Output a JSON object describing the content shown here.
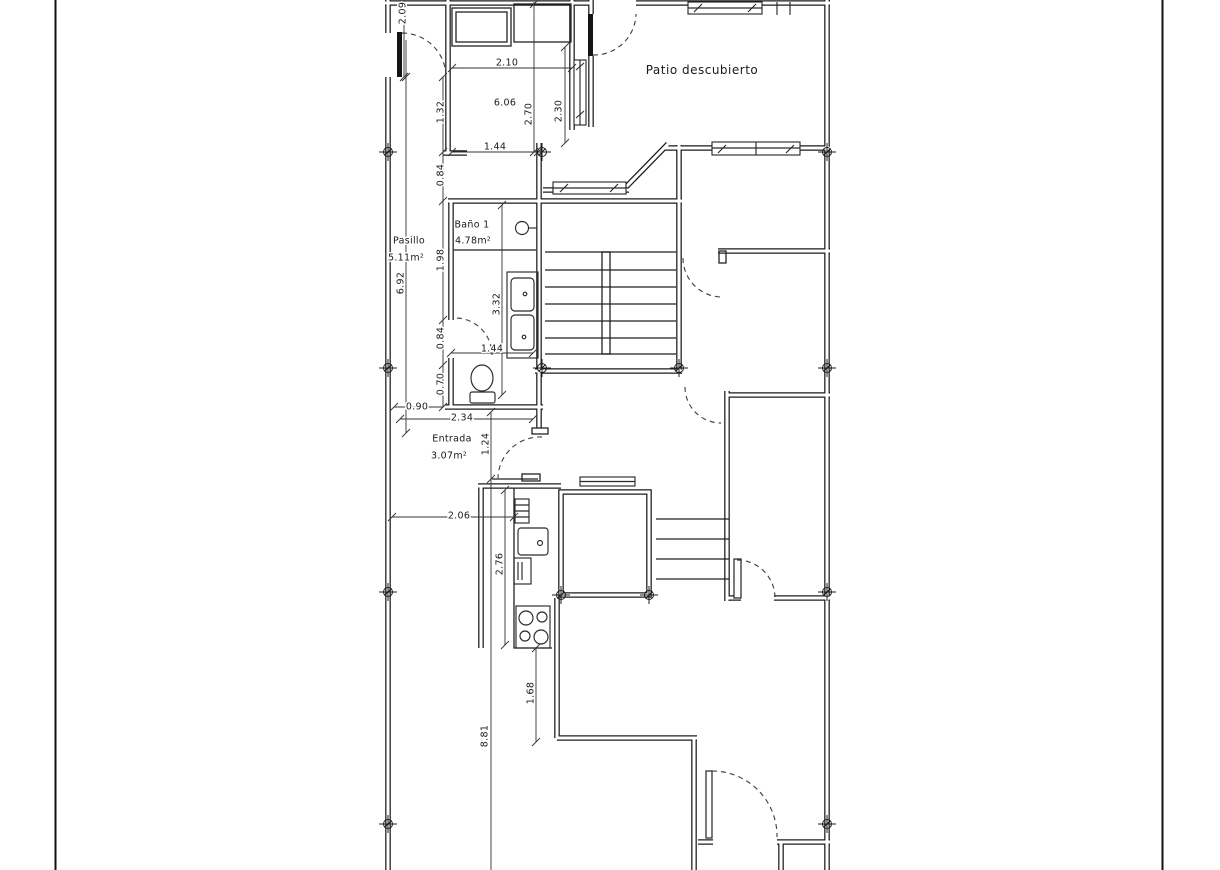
{
  "drawing": {
    "type": "architectural floor plan",
    "background": "#ffffff",
    "line_color": "#1c1c1c"
  },
  "rooms": {
    "patio": {
      "name": "Patio descubierto"
    },
    "pasillo": {
      "name": "Pasillo",
      "area": "5.11m²"
    },
    "bano": {
      "name": "Baño 1",
      "area": "4.78m²"
    },
    "entrada": {
      "name": "Entrada",
      "area": "3.07m²"
    }
  },
  "dimensions": {
    "v209": "2.09",
    "v132": "1.32",
    "v084a": "0.84",
    "v198": "1.98",
    "v084b": "0.84",
    "v070": "0.70",
    "v692": "6.92",
    "v090": "0.90",
    "v234": "2.34",
    "v124": "1.24",
    "v206": "2.06",
    "v276": "2.76",
    "v168": "1.68",
    "v881": "8.81",
    "v210": "2.10",
    "v606": "6.06",
    "v270": "2.70",
    "v230": "2.30",
    "v144a": "1.44",
    "v332": "3.32",
    "v144b": "1.44"
  }
}
